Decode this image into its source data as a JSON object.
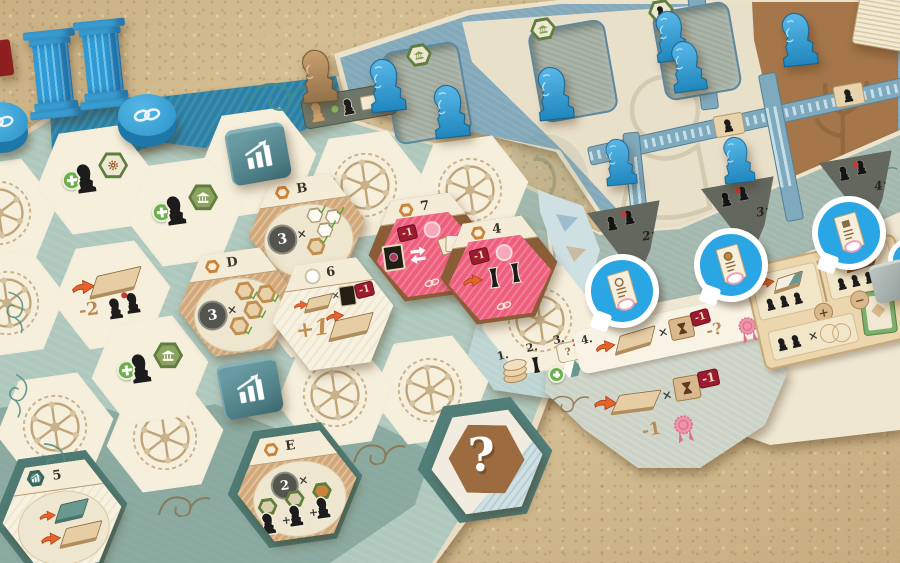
{
  "symbols": {
    "times": "×",
    "plus": "+",
    "minus": "−"
  },
  "tiles": {
    "b": {
      "letter": "B",
      "count": "3"
    },
    "d": {
      "letter": "D",
      "count": "3"
    },
    "e": {
      "letter": "E",
      "count": "2"
    },
    "t7": {
      "number": "7",
      "penalty": "-1"
    },
    "t4": {
      "number": "4",
      "penalty": "-1"
    },
    "t6": {
      "number": "6",
      "penalty": "-1",
      "bonus": "+1"
    },
    "t5": {
      "number": "5"
    },
    "mystery": {
      "mark": "?"
    }
  },
  "board": {
    "hex_penalty": "-2"
  },
  "token_spaces": {
    "s2": "2×",
    "s3": "3×",
    "s4": "4×"
  },
  "sequence": {
    "n1": "1.",
    "n2": "2.",
    "n3": "3.",
    "n4": "4.",
    "step3_mark": "?",
    "penalty": "-1",
    "unknown": "-?"
  },
  "extension": {
    "penalty": "-1",
    "seal_penalty": "-1"
  },
  "colors": {
    "piece_blue": "#2d9fd9",
    "band_blue": "#2a81a5",
    "board_sage": "#aec8bd",
    "agora_blue": "#83a9bb",
    "pink": "#ee5f7d",
    "badge_red": "#9c1b2e",
    "seal_pink": "#ef93ab",
    "bubble_blue": "#2aa6e4",
    "accent_orange": "#e8632c",
    "wood_tan": "#d2a878",
    "wood_brown": "#8a5d36",
    "slot_grey": "#a9b3a7",
    "triangle_grey": "#63675e",
    "sand": "#d2bb8e"
  },
  "icons": {
    "chain": "chain-link",
    "bars": "bar-chart",
    "bust": "statue-bust",
    "column": "ionic-column",
    "seal": "wax-seal",
    "hourglass": "hourglass",
    "swap": "swap-arrows",
    "cards": "cards",
    "gear": "gear",
    "temple": "temple",
    "check": "checkmark",
    "speech": "speech-bubble",
    "tile": "floor-tile",
    "arrow": "gain-arrow",
    "rosette": "rosette-mosaic"
  }
}
